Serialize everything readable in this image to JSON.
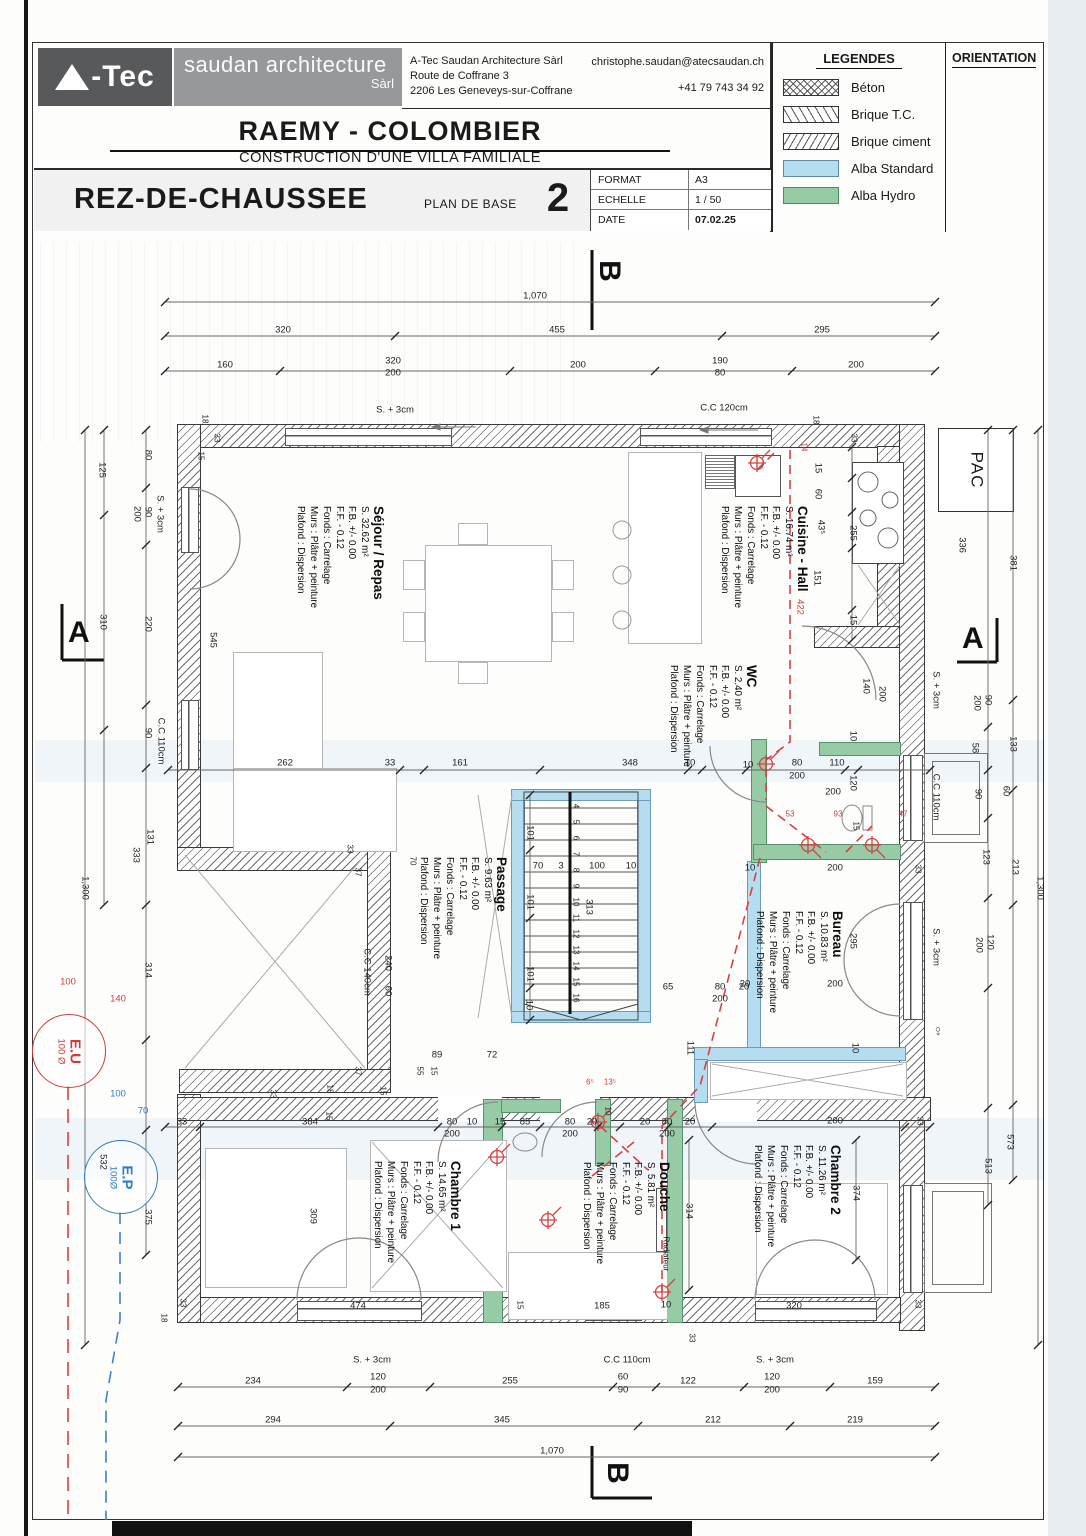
{
  "header": {
    "logo_text": "-Tec",
    "logo_sub": "saudan architecture",
    "logo_sub2": "Sàrl",
    "address_line1": "A-Tec Saudan Architecture Sàrl",
    "address_line2": "Route de Coffrane 3",
    "address_line3": "2206 Les Geneveys-sur-Coffrane",
    "email": "christophe.saudan@atecsaudan.ch",
    "phone": "+41 79 743 34 92",
    "project_title": "RAEMY - COLOMBIER",
    "project_subtitle": "CONSTRUCTION D'UNE VILLA FAMILIALE",
    "sheet_title": "REZ-DE-CHAUSSEE",
    "plan_type": "PLAN DE BASE",
    "sheet_number": "2",
    "meta": {
      "format_label": "FORMAT",
      "format_value": "A3",
      "echelle_label": "ECHELLE",
      "echelle_value": "1 / 50",
      "date_label": "DATE",
      "date_value": "07.02.25"
    },
    "legends_title": "LEGENDES",
    "legend_items": [
      {
        "label": "Béton"
      },
      {
        "label": "Brique T.C."
      },
      {
        "label": "Brique ciment"
      },
      {
        "label": "Alba Standard",
        "color": "#b5dcef"
      },
      {
        "label": "Alba Hydro",
        "color": "#97cba6"
      }
    ],
    "orientation_title": "ORIENTATION"
  },
  "rooms": [
    {
      "name": "Séjour / Repas",
      "area": "S. 32.62 m²",
      "fb": "F.B. +/- 0.00",
      "ff": "F.F. - 0.12",
      "fonds": "Fonds : Carrelage",
      "murs": "Murs : Plâtre + peinture",
      "plafond": "Plafond : Dispersion"
    },
    {
      "name": "Cuisine - Hall",
      "area": "S. 16.74 m²",
      "fb": "F.B. +/- 0.00",
      "ff": "F.F. - 0.12",
      "fonds": "Fonds : Carrelage",
      "murs": "Murs : Plâtre + peinture",
      "plafond": "Plafond : Dispersion"
    },
    {
      "name": "WC",
      "area": "S. 2.40 m²",
      "fb": "F.B. +/- 0.00",
      "ff": "F.F. - 0.12",
      "fonds": "Fonds : Carrelage",
      "murs": "Murs : Plâtre + peinture",
      "plafond": "Plafond : Dispersion"
    },
    {
      "name": "Passage",
      "area": "S. 9.63 m²",
      "fb": "F.B. +/- 0.00",
      "ff": "F.F. - 0.12",
      "fonds": "Fonds : Carrelage",
      "murs": "Murs : Plâtre + peinture",
      "plafond": "Plafond : Dispersion"
    },
    {
      "name": "Bureau",
      "area": "S. 10.83 m²",
      "fb": "F.B. +/- 0.00",
      "ff": "F.F. - 0.12",
      "fonds": "Fonds : Carrelage",
      "murs": "Murs : Plâtre + peinture",
      "plafond": "Plafond : Dispersion"
    },
    {
      "name": "Chambre 1",
      "area": "S. 14.65 m²",
      "fb": "F.B. +/- 0.00",
      "ff": "F.F. - 0.12",
      "fonds": "Fonds : Carrelage",
      "murs": "Murs : Plâtre + peinture",
      "plafond": "Plafond : Dispersion"
    },
    {
      "name": "Douche",
      "area": "S. 5.81 m²",
      "fb": "F.B. +/- 0.00",
      "ff": "F.F. - 0.12",
      "fonds": "Fonds : Carrelage",
      "murs": "Murs : Plâtre + peinture",
      "plafond": "Plafond : Dispersion"
    },
    {
      "name": "Chambre 2",
      "area": "S. 11.26 m²",
      "fb": "F.B. +/- 0.00",
      "ff": "F.F. - 0.12",
      "fonds": "Fonds : Carrelage",
      "murs": "Murs : Plâtre + peinture",
      "plafond": "Plafond : Dispersion"
    }
  ],
  "annotations": {
    "pac": "PAC",
    "eu": "E.U",
    "eu_dia": "100 Ø",
    "ep": "E.P",
    "ep_dia": "100Ø",
    "male_symbol": "♂",
    "section_a": "A",
    "section_b": "B"
  },
  "colors": {
    "accent_red": "#cf3b3b",
    "accent_blue": "#2f7cc4",
    "alba_standard": "#b5dcef",
    "alba_hydro": "#97cba6"
  },
  "dim_labels": [
    {
      "t": "1,070",
      "x": 535,
      "y": 296
    },
    {
      "t": "320",
      "x": 283,
      "y": 330
    },
    {
      "t": "455",
      "x": 557,
      "y": 330
    },
    {
      "t": "295",
      "x": 822,
      "y": 330
    },
    {
      "t": "160",
      "x": 225,
      "y": 365
    },
    {
      "t": "320",
      "x": 393,
      "y": 361
    },
    {
      "t": "200",
      "x": 393,
      "y": 373
    },
    {
      "t": "200",
      "x": 578,
      "y": 365
    },
    {
      "t": "190",
      "x": 720,
      "y": 361
    },
    {
      "t": "80",
      "x": 720,
      "y": 373
    },
    {
      "t": "200",
      "x": 856,
      "y": 365
    },
    {
      "t": "S. + 3cm",
      "x": 395,
      "y": 410
    },
    {
      "t": "C.C 120cm",
      "x": 724,
      "y": 408
    },
    {
      "t": "18",
      "x": 205,
      "y": 419,
      "r": 1,
      "s": 1
    },
    {
      "t": "33",
      "x": 217,
      "y": 438,
      "r": 1,
      "s": 1
    },
    {
      "t": "15",
      "x": 201,
      "y": 456,
      "r": 1,
      "s": 1
    },
    {
      "t": "18",
      "x": 816,
      "y": 420,
      "r": 1,
      "s": 1
    },
    {
      "t": "33",
      "x": 854,
      "y": 438,
      "r": 1,
      "s": 1
    },
    {
      "t": "15",
      "x": 818,
      "y": 468,
      "r": 1
    },
    {
      "t": "60",
      "x": 818,
      "y": 494,
      "r": 1
    },
    {
      "t": "43⁵",
      "x": 821,
      "y": 527,
      "r": 1
    },
    {
      "t": "255",
      "x": 853,
      "y": 533,
      "r": 1
    },
    {
      "t": "151",
      "x": 817,
      "y": 578,
      "r": 1
    },
    {
      "t": "15",
      "x": 853,
      "y": 620,
      "r": 1
    },
    {
      "t": "14",
      "x": 804,
      "y": 447,
      "r": 1,
      "c": "red",
      "s": 1
    },
    {
      "t": "422",
      "x": 800,
      "y": 607,
      "r": 1,
      "c": "red"
    },
    {
      "t": "336",
      "x": 962,
      "y": 545,
      "r": 1
    },
    {
      "t": "381",
      "x": 1013,
      "y": 563,
      "r": 1
    },
    {
      "t": "90",
      "x": 988,
      "y": 700,
      "r": 1
    },
    {
      "t": "200",
      "x": 977,
      "y": 703,
      "r": 1
    },
    {
      "t": "S. + 3cm",
      "x": 936,
      "y": 690,
      "r": 1
    },
    {
      "t": "58",
      "x": 975,
      "y": 748,
      "r": 1
    },
    {
      "t": "133",
      "x": 1013,
      "y": 744,
      "r": 1
    },
    {
      "t": "C.C 110cm",
      "x": 936,
      "y": 797,
      "r": 1
    },
    {
      "t": "90",
      "x": 978,
      "y": 794,
      "r": 1
    },
    {
      "t": "60",
      "x": 1006,
      "y": 791,
      "r": 1
    },
    {
      "t": "123",
      "x": 986,
      "y": 857,
      "r": 1
    },
    {
      "t": "213",
      "x": 1015,
      "y": 867,
      "r": 1
    },
    {
      "t": "33",
      "x": 918,
      "y": 869,
      "r": 1,
      "s": 1
    },
    {
      "t": "1,300",
      "x": 1040,
      "y": 888,
      "r": 1
    },
    {
      "t": "S. + 3cm",
      "x": 936,
      "y": 947,
      "r": 1
    },
    {
      "t": "120",
      "x": 990,
      "y": 942,
      "r": 1
    },
    {
      "t": "200",
      "x": 979,
      "y": 945,
      "r": 1
    },
    {
      "t": "573",
      "x": 1010,
      "y": 1142,
      "r": 1
    },
    {
      "t": "513",
      "x": 988,
      "y": 1166,
      "r": 1
    },
    {
      "t": "33",
      "x": 920,
      "y": 1121,
      "r": 1,
      "s": 1
    },
    {
      "t": "374",
      "x": 856,
      "y": 1193,
      "r": 1
    },
    {
      "t": "33",
      "x": 918,
      "y": 1304,
      "r": 1,
      "s": 1
    },
    {
      "t": "125",
      "x": 102,
      "y": 470,
      "r": 1
    },
    {
      "t": "80",
      "x": 148,
      "y": 455,
      "r": 1
    },
    {
      "t": "90",
      "x": 148,
      "y": 512,
      "r": 1
    },
    {
      "t": "200",
      "x": 137,
      "y": 514,
      "r": 1
    },
    {
      "t": "S. + 3cm",
      "x": 160,
      "y": 514,
      "r": 1
    },
    {
      "t": "310",
      "x": 103,
      "y": 622,
      "r": 1
    },
    {
      "t": "220",
      "x": 148,
      "y": 624,
      "r": 1
    },
    {
      "t": "545",
      "x": 213,
      "y": 640,
      "r": 1
    },
    {
      "t": "90",
      "x": 148,
      "y": 733,
      "r": 1
    },
    {
      "t": "C.C 110cm",
      "x": 161,
      "y": 741,
      "r": 1
    },
    {
      "t": "131",
      "x": 150,
      "y": 837,
      "r": 1
    },
    {
      "t": "333",
      "x": 136,
      "y": 855,
      "r": 1
    },
    {
      "t": "1,300",
      "x": 85,
      "y": 888,
      "r": 1
    },
    {
      "t": "314",
      "x": 148,
      "y": 970,
      "r": 1
    },
    {
      "t": "532",
      "x": 103,
      "y": 1162,
      "r": 1
    },
    {
      "t": "375",
      "x": 148,
      "y": 1217,
      "r": 1
    },
    {
      "t": "100",
      "x": 68,
      "y": 982,
      "c": "red"
    },
    {
      "t": "140",
      "x": 118,
      "y": 999,
      "c": "red"
    },
    {
      "t": "100",
      "x": 118,
      "y": 1094,
      "c": "blue"
    },
    {
      "t": "70",
      "x": 143,
      "y": 1111,
      "c": "blue"
    },
    {
      "t": "262",
      "x": 285,
      "y": 763
    },
    {
      "t": "33",
      "x": 390,
      "y": 763
    },
    {
      "t": "161",
      "x": 460,
      "y": 763
    },
    {
      "t": "348",
      "x": 630,
      "y": 763
    },
    {
      "t": "10",
      "x": 690,
      "y": 763
    },
    {
      "t": "10",
      "x": 748,
      "y": 765
    },
    {
      "t": "80",
      "x": 797,
      "y": 763
    },
    {
      "t": "200",
      "x": 797,
      "y": 776
    },
    {
      "t": "110",
      "x": 837,
      "y": 763
    },
    {
      "t": "200",
      "x": 833,
      "y": 792
    },
    {
      "t": "140",
      "x": 866,
      "y": 686,
      "r": 1
    },
    {
      "t": "200",
      "x": 882,
      "y": 694,
      "r": 1
    },
    {
      "t": "10",
      "x": 853,
      "y": 736,
      "r": 1
    },
    {
      "t": "120",
      "x": 853,
      "y": 783,
      "r": 1
    },
    {
      "t": "53",
      "x": 790,
      "y": 814,
      "c": "red",
      "s": 1
    },
    {
      "t": "93",
      "x": 838,
      "y": 814,
      "c": "red",
      "s": 1
    },
    {
      "t": "47",
      "x": 903,
      "y": 814,
      "c": "red",
      "s": 1
    },
    {
      "t": "15",
      "x": 856,
      "y": 826,
      "r": 1,
      "s": 1
    },
    {
      "t": "101",
      "x": 530,
      "y": 833,
      "r": 1
    },
    {
      "t": "70",
      "x": 538,
      "y": 866
    },
    {
      "t": "3",
      "x": 561,
      "y": 866
    },
    {
      "t": "100",
      "x": 597,
      "y": 866
    },
    {
      "t": "10",
      "x": 631,
      "y": 866
    },
    {
      "t": "313",
      "x": 589,
      "y": 907,
      "r": 1
    },
    {
      "t": "101",
      "x": 530,
      "y": 902,
      "r": 1
    },
    {
      "t": "101",
      "x": 530,
      "y": 974,
      "r": 1
    },
    {
      "t": "10",
      "x": 529,
      "y": 1005,
      "r": 1
    },
    {
      "t": "65",
      "x": 668,
      "y": 987
    },
    {
      "t": "80",
      "x": 720,
      "y": 987
    },
    {
      "t": "200",
      "x": 720,
      "y": 999
    },
    {
      "t": "20",
      "x": 744,
      "y": 987
    },
    {
      "t": "111",
      "x": 690,
      "y": 1048,
      "r": 1
    },
    {
      "t": "4",
      "x": 576,
      "y": 806,
      "r": 1,
      "s": 1
    },
    {
      "t": "5",
      "x": 576,
      "y": 822,
      "r": 1,
      "s": 1
    },
    {
      "t": "6",
      "x": 576,
      "y": 838,
      "r": 1,
      "s": 1
    },
    {
      "t": "7",
      "x": 576,
      "y": 854,
      "r": 1,
      "s": 1
    },
    {
      "t": "8",
      "x": 576,
      "y": 870,
      "r": 1,
      "s": 1
    },
    {
      "t": "9",
      "x": 576,
      "y": 886,
      "r": 1,
      "s": 1
    },
    {
      "t": "10",
      "x": 576,
      "y": 902,
      "r": 1,
      "s": 1
    },
    {
      "t": "11",
      "x": 576,
      "y": 918,
      "r": 1,
      "s": 1
    },
    {
      "t": "12",
      "x": 576,
      "y": 934,
      "r": 1,
      "s": 1
    },
    {
      "t": "13",
      "x": 576,
      "y": 950,
      "r": 1,
      "s": 1
    },
    {
      "t": "14",
      "x": 576,
      "y": 966,
      "r": 1,
      "s": 1
    },
    {
      "t": "15",
      "x": 576,
      "y": 982,
      "r": 1,
      "s": 1
    },
    {
      "t": "16",
      "x": 576,
      "y": 998,
      "r": 1,
      "s": 1
    },
    {
      "t": "C.C 140cm",
      "x": 367,
      "y": 972,
      "r": 1
    },
    {
      "t": "240",
      "x": 388,
      "y": 963,
      "r": 1
    },
    {
      "t": "60",
      "x": 388,
      "y": 991,
      "r": 1
    },
    {
      "t": "33",
      "x": 350,
      "y": 849,
      "r": 1,
      "s": 1
    },
    {
      "t": "37",
      "x": 358,
      "y": 872,
      "r": 1,
      "s": 1
    },
    {
      "t": "70",
      "x": 413,
      "y": 861,
      "r": 1,
      "s": 1
    },
    {
      "t": "37",
      "x": 358,
      "y": 1071,
      "r": 1,
      "s": 1
    },
    {
      "t": "55",
      "x": 420,
      "y": 1071,
      "r": 1,
      "s": 1
    },
    {
      "t": "15",
      "x": 434,
      "y": 1071,
      "r": 1,
      "s": 1
    },
    {
      "t": "89",
      "x": 437,
      "y": 1055
    },
    {
      "t": "72",
      "x": 492,
      "y": 1055
    },
    {
      "t": "10",
      "x": 750,
      "y": 868
    },
    {
      "t": "200",
      "x": 835,
      "y": 868
    },
    {
      "t": "295",
      "x": 853,
      "y": 941,
      "r": 1
    },
    {
      "t": "200",
      "x": 835,
      "y": 984
    },
    {
      "t": "20",
      "x": 745,
      "y": 984
    },
    {
      "t": "10",
      "x": 855,
      "y": 1048,
      "r": 1
    },
    {
      "t": "33",
      "x": 182,
      "y": 1122
    },
    {
      "t": "384",
      "x": 310,
      "y": 1122
    },
    {
      "t": "15",
      "x": 329,
      "y": 1116,
      "r": 1,
      "s": 1
    },
    {
      "t": "80",
      "x": 452,
      "y": 1122
    },
    {
      "t": "200",
      "x": 452,
      "y": 1134
    },
    {
      "t": "10",
      "x": 472,
      "y": 1122
    },
    {
      "t": "15",
      "x": 500,
      "y": 1122
    },
    {
      "t": "85",
      "x": 525,
      "y": 1122
    },
    {
      "t": "80",
      "x": 570,
      "y": 1122
    },
    {
      "t": "200",
      "x": 570,
      "y": 1134
    },
    {
      "t": "20",
      "x": 592,
      "y": 1122
    },
    {
      "t": "10",
      "x": 608,
      "y": 1111,
      "r": 1,
      "s": 1
    },
    {
      "t": "20",
      "x": 645,
      "y": 1122
    },
    {
      "t": "80",
      "x": 667,
      "y": 1122
    },
    {
      "t": "200",
      "x": 667,
      "y": 1134
    },
    {
      "t": "20",
      "x": 690,
      "y": 1122
    },
    {
      "t": "200",
      "x": 835,
      "y": 1121
    },
    {
      "t": "33",
      "x": 273,
      "y": 1094,
      "r": 1,
      "s": 1
    },
    {
      "t": "18",
      "x": 330,
      "y": 1089,
      "r": 1,
      "s": 1
    },
    {
      "t": "15",
      "x": 383,
      "y": 1091,
      "r": 1,
      "s": 1
    },
    {
      "t": "6⁵",
      "x": 590,
      "y": 1082,
      "c": "red",
      "s": 1
    },
    {
      "t": "13⁵",
      "x": 610,
      "y": 1082,
      "c": "red",
      "s": 1
    },
    {
      "t": "309",
      "x": 313,
      "y": 1216,
      "r": 1
    },
    {
      "t": "314",
      "x": 689,
      "y": 1211,
      "r": 1
    },
    {
      "t": "Radiateur",
      "x": 666,
      "y": 1254,
      "r": 1,
      "s": 1
    },
    {
      "t": "185",
      "x": 602,
      "y": 1306
    },
    {
      "t": "10",
      "x": 666,
      "y": 1305
    },
    {
      "t": "320",
      "x": 794,
      "y": 1306
    },
    {
      "t": "474",
      "x": 358,
      "y": 1306
    },
    {
      "t": "33",
      "x": 692,
      "y": 1338,
      "r": 1,
      "s": 1
    },
    {
      "t": "15",
      "x": 520,
      "y": 1305,
      "r": 1,
      "s": 1
    },
    {
      "t": "33",
      "x": 183,
      "y": 1303,
      "r": 1,
      "s": 1
    },
    {
      "t": "18",
      "x": 164,
      "y": 1318,
      "r": 1,
      "s": 1
    },
    {
      "t": "S. + 3cm",
      "x": 372,
      "y": 1360
    },
    {
      "t": "C.C 110cm",
      "x": 627,
      "y": 1360
    },
    {
      "t": "S. + 3cm",
      "x": 775,
      "y": 1360
    },
    {
      "t": "234",
      "x": 253,
      "y": 1381
    },
    {
      "t": "120",
      "x": 378,
      "y": 1377
    },
    {
      "t": "200",
      "x": 378,
      "y": 1390
    },
    {
      "t": "255",
      "x": 510,
      "y": 1381
    },
    {
      "t": "60",
      "x": 623,
      "y": 1377
    },
    {
      "t": "90",
      "x": 623,
      "y": 1390
    },
    {
      "t": "122",
      "x": 688,
      "y": 1381
    },
    {
      "t": "120",
      "x": 772,
      "y": 1377
    },
    {
      "t": "200",
      "x": 772,
      "y": 1390
    },
    {
      "t": "159",
      "x": 875,
      "y": 1381
    },
    {
      "t": "294",
      "x": 273,
      "y": 1420
    },
    {
      "t": "345",
      "x": 502,
      "y": 1420
    },
    {
      "t": "212",
      "x": 713,
      "y": 1420
    },
    {
      "t": "219",
      "x": 855,
      "y": 1420
    },
    {
      "t": "1,070",
      "x": 552,
      "y": 1451
    }
  ],
  "dim_lines": [
    {
      "o": "h",
      "y": 302,
      "a": 165,
      "b": 935,
      "t": [
        165,
        935
      ]
    },
    {
      "o": "h",
      "y": 336,
      "a": 165,
      "b": 935,
      "t": [
        165,
        395,
        722,
        935
      ]
    },
    {
      "o": "h",
      "y": 371,
      "a": 165,
      "b": 935,
      "t": [
        165,
        280,
        510,
        655,
        792,
        935
      ]
    },
    {
      "o": "h",
      "y": 770,
      "a": 168,
      "b": 930,
      "t": [
        168,
        400,
        424,
        540,
        688,
        702,
        746,
        845,
        858,
        930
      ]
    },
    {
      "o": "h",
      "y": 1127,
      "a": 165,
      "b": 930,
      "t": [
        165,
        200,
        438,
        502,
        540,
        598,
        620,
        668,
        712,
        905,
        930
      ]
    },
    {
      "o": "h",
      "y": 1387,
      "a": 178,
      "b": 935,
      "t": [
        178,
        347,
        430,
        613,
        656,
        744,
        830,
        935
      ]
    },
    {
      "o": "h",
      "y": 1426,
      "a": 178,
      "b": 935,
      "t": [
        178,
        390,
        638,
        790,
        935
      ]
    },
    {
      "o": "h",
      "y": 1457,
      "a": 178,
      "b": 935,
      "t": [
        178,
        935
      ]
    },
    {
      "o": "v",
      "x": 85,
      "a": 430,
      "b": 1345,
      "t": [
        430,
        1345
      ]
    },
    {
      "o": "v",
      "x": 104,
      "a": 430,
      "b": 905,
      "t": [
        430,
        515,
        730,
        905
      ]
    },
    {
      "o": "v",
      "x": 146,
      "a": 430,
      "b": 1255,
      "t": [
        430,
        488,
        545,
        705,
        768,
        905,
        1040,
        1130,
        1255
      ]
    },
    {
      "o": "v",
      "x": 1038,
      "a": 430,
      "b": 1345,
      "t": [
        430,
        1345
      ]
    },
    {
      "o": "v",
      "x": 1013,
      "a": 430,
      "b": 1180,
      "t": [
        430,
        700,
        790,
        905,
        1105,
        1180
      ]
    },
    {
      "o": "v",
      "x": 988,
      "a": 430,
      "b": 1205,
      "t": [
        430,
        727,
        770,
        818,
        898,
        988,
        1108,
        1205
      ]
    },
    {
      "o": "v",
      "x": 852,
      "a": 447,
      "b": 640,
      "t": [
        447,
        478,
        512,
        548,
        610,
        640
      ]
    },
    {
      "o": "v",
      "x": 689,
      "a": 1140,
      "b": 1290,
      "t": [
        1140,
        1290
      ]
    },
    {
      "o": "v",
      "x": 856,
      "a": 1140,
      "b": 1260,
      "t": [
        1140,
        1260
      ]
    },
    {
      "o": "v",
      "x": 530,
      "a": 795,
      "b": 1020,
      "t": [
        795,
        850,
        918,
        988,
        1020
      ]
    }
  ]
}
